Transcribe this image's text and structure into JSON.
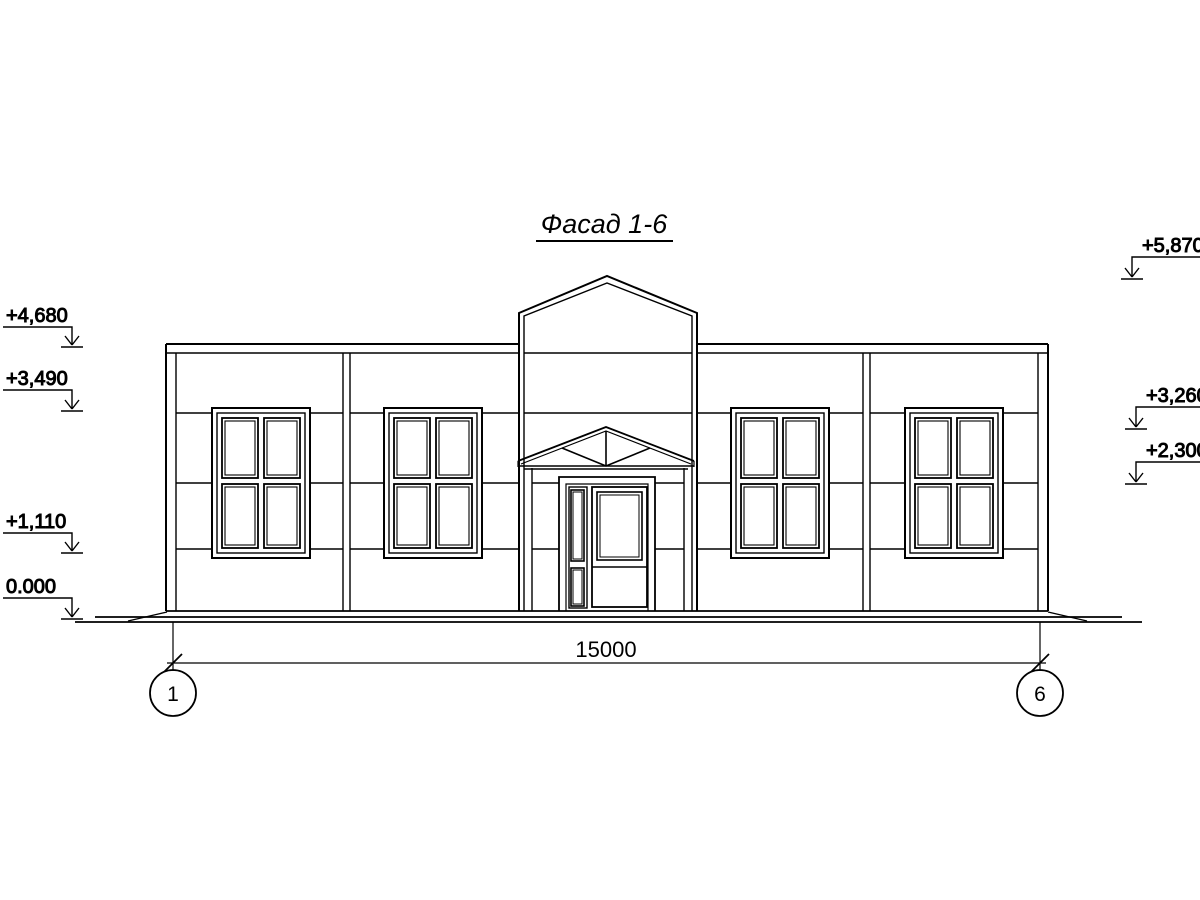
{
  "title": {
    "text": "Фасад 1-6"
  },
  "elevation_marks": {
    "left": [
      {
        "label": "+4,680"
      },
      {
        "label": "+3,490"
      },
      {
        "label": "+1,110"
      },
      {
        "label": "0.000"
      }
    ],
    "right": [
      {
        "label": "+5,870"
      },
      {
        "label": "+3,260"
      },
      {
        "label": "+2,300"
      }
    ]
  },
  "dimension": {
    "label": "15000"
  },
  "axes": {
    "left": "1",
    "right": "6"
  },
  "colors": {
    "line": "#000000",
    "background": "#ffffff"
  }
}
